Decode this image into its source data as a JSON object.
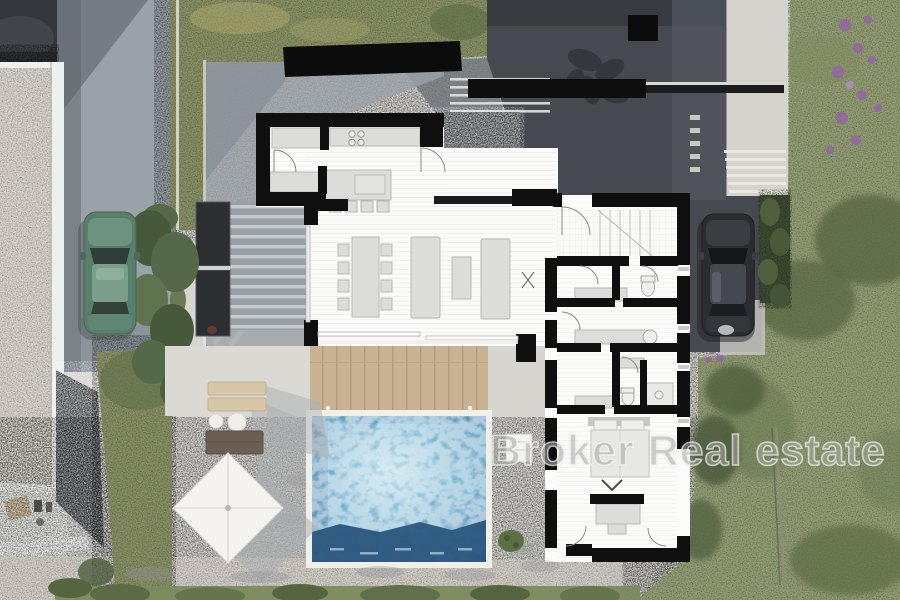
{
  "scene": {
    "title": "aerial-villa-floorplan-render",
    "watermark": {
      "text": "Broker Real estate"
    },
    "palette": {
      "grass": "#8b9367",
      "grass_light": "#95a076",
      "grass_shadow": "#55653f",
      "hedge": "#4e5e3c",
      "concrete_light": "#d6d5d0",
      "concrete_mid": "#9aa2a9",
      "concrete_dark": "#46494f",
      "gravel_light": "#dcd7d0",
      "gravel_dark": "#45474b",
      "pebble_path": "#d5d1c9",
      "wall_black": "#0f0f0f",
      "floor_white": "#fbfbfa",
      "furniture_gray": "#dcdcda",
      "wood_deck": "#c9b293",
      "pool_shallow": "#a8d4e4",
      "pool_mid": "#5fa3c6",
      "pool_deep": "#2a567e",
      "umbrella": "#f4f3ef",
      "car_green": "#587e6c",
      "car_dark": "#2b2d31",
      "flowers_purple": "#9662ab"
    },
    "objects": {
      "pool": "swimming-pool",
      "umbrella": "square-parasol",
      "car_left": "green-car",
      "car_right": "black-car",
      "deck": "wooden-deck",
      "plan": "villa-floor-plan"
    }
  }
}
